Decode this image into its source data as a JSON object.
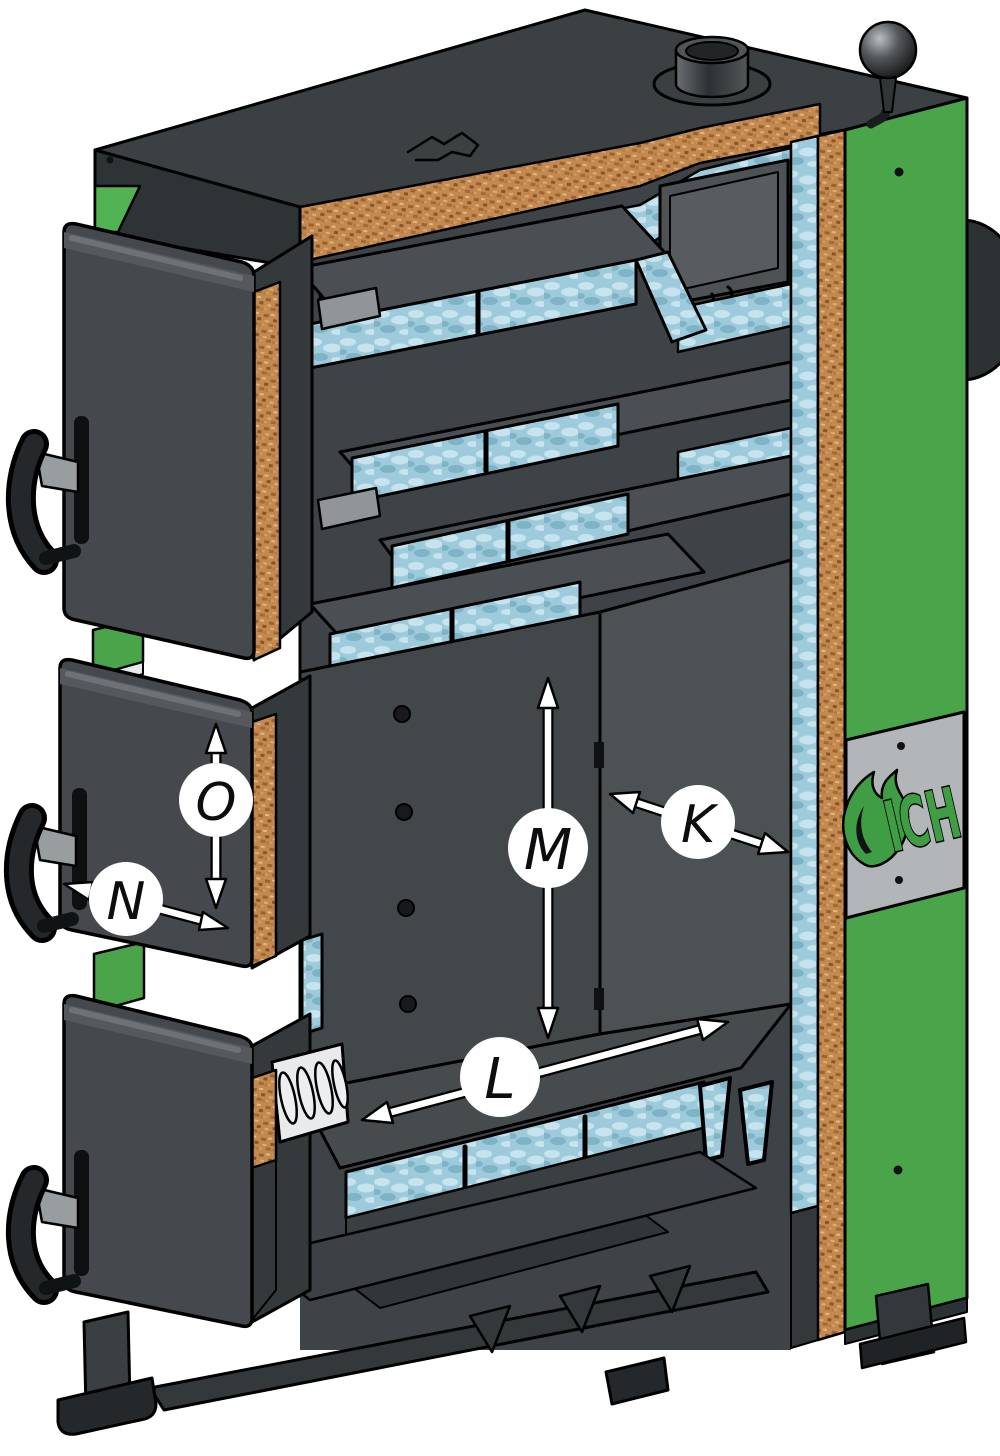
{
  "scene": {
    "type": "boiler-cutaway-diagram",
    "description": "Cutaway technical illustration of a SICH solid-fuel heating boiler showing steel body, cork insulation, water jacket, heat-exchanger plates and dimension reference labels"
  },
  "brand": {
    "text": "ICH",
    "full_name": "SICH",
    "icon": "flame-s-icon"
  },
  "dimension_labels": {
    "k": "K",
    "l": "L",
    "m": "M",
    "n": "N",
    "o": "O"
  },
  "colors": {
    "background": "#ffffff",
    "outline": "#000000",
    "steel_dark": "#2e3336",
    "steel_top": "#3b4043",
    "steel_body": "#45494d",
    "steel_interior": "#42474a",
    "steel_plate": "#4a4f53",
    "panel_green": "#4aa54a",
    "panel_green_bright": "#53b253",
    "insulation_cork": "#c28a52",
    "water_blue": "#9ecbdb",
    "water_blue_light": "#c6e3ee",
    "water_blue_deep": "#7fb3c6",
    "plate_gray": "#b2b6b9",
    "logo_green": "#3f9e44",
    "grate_white": "#e8eaec",
    "arrow_white": "#ffffff"
  }
}
